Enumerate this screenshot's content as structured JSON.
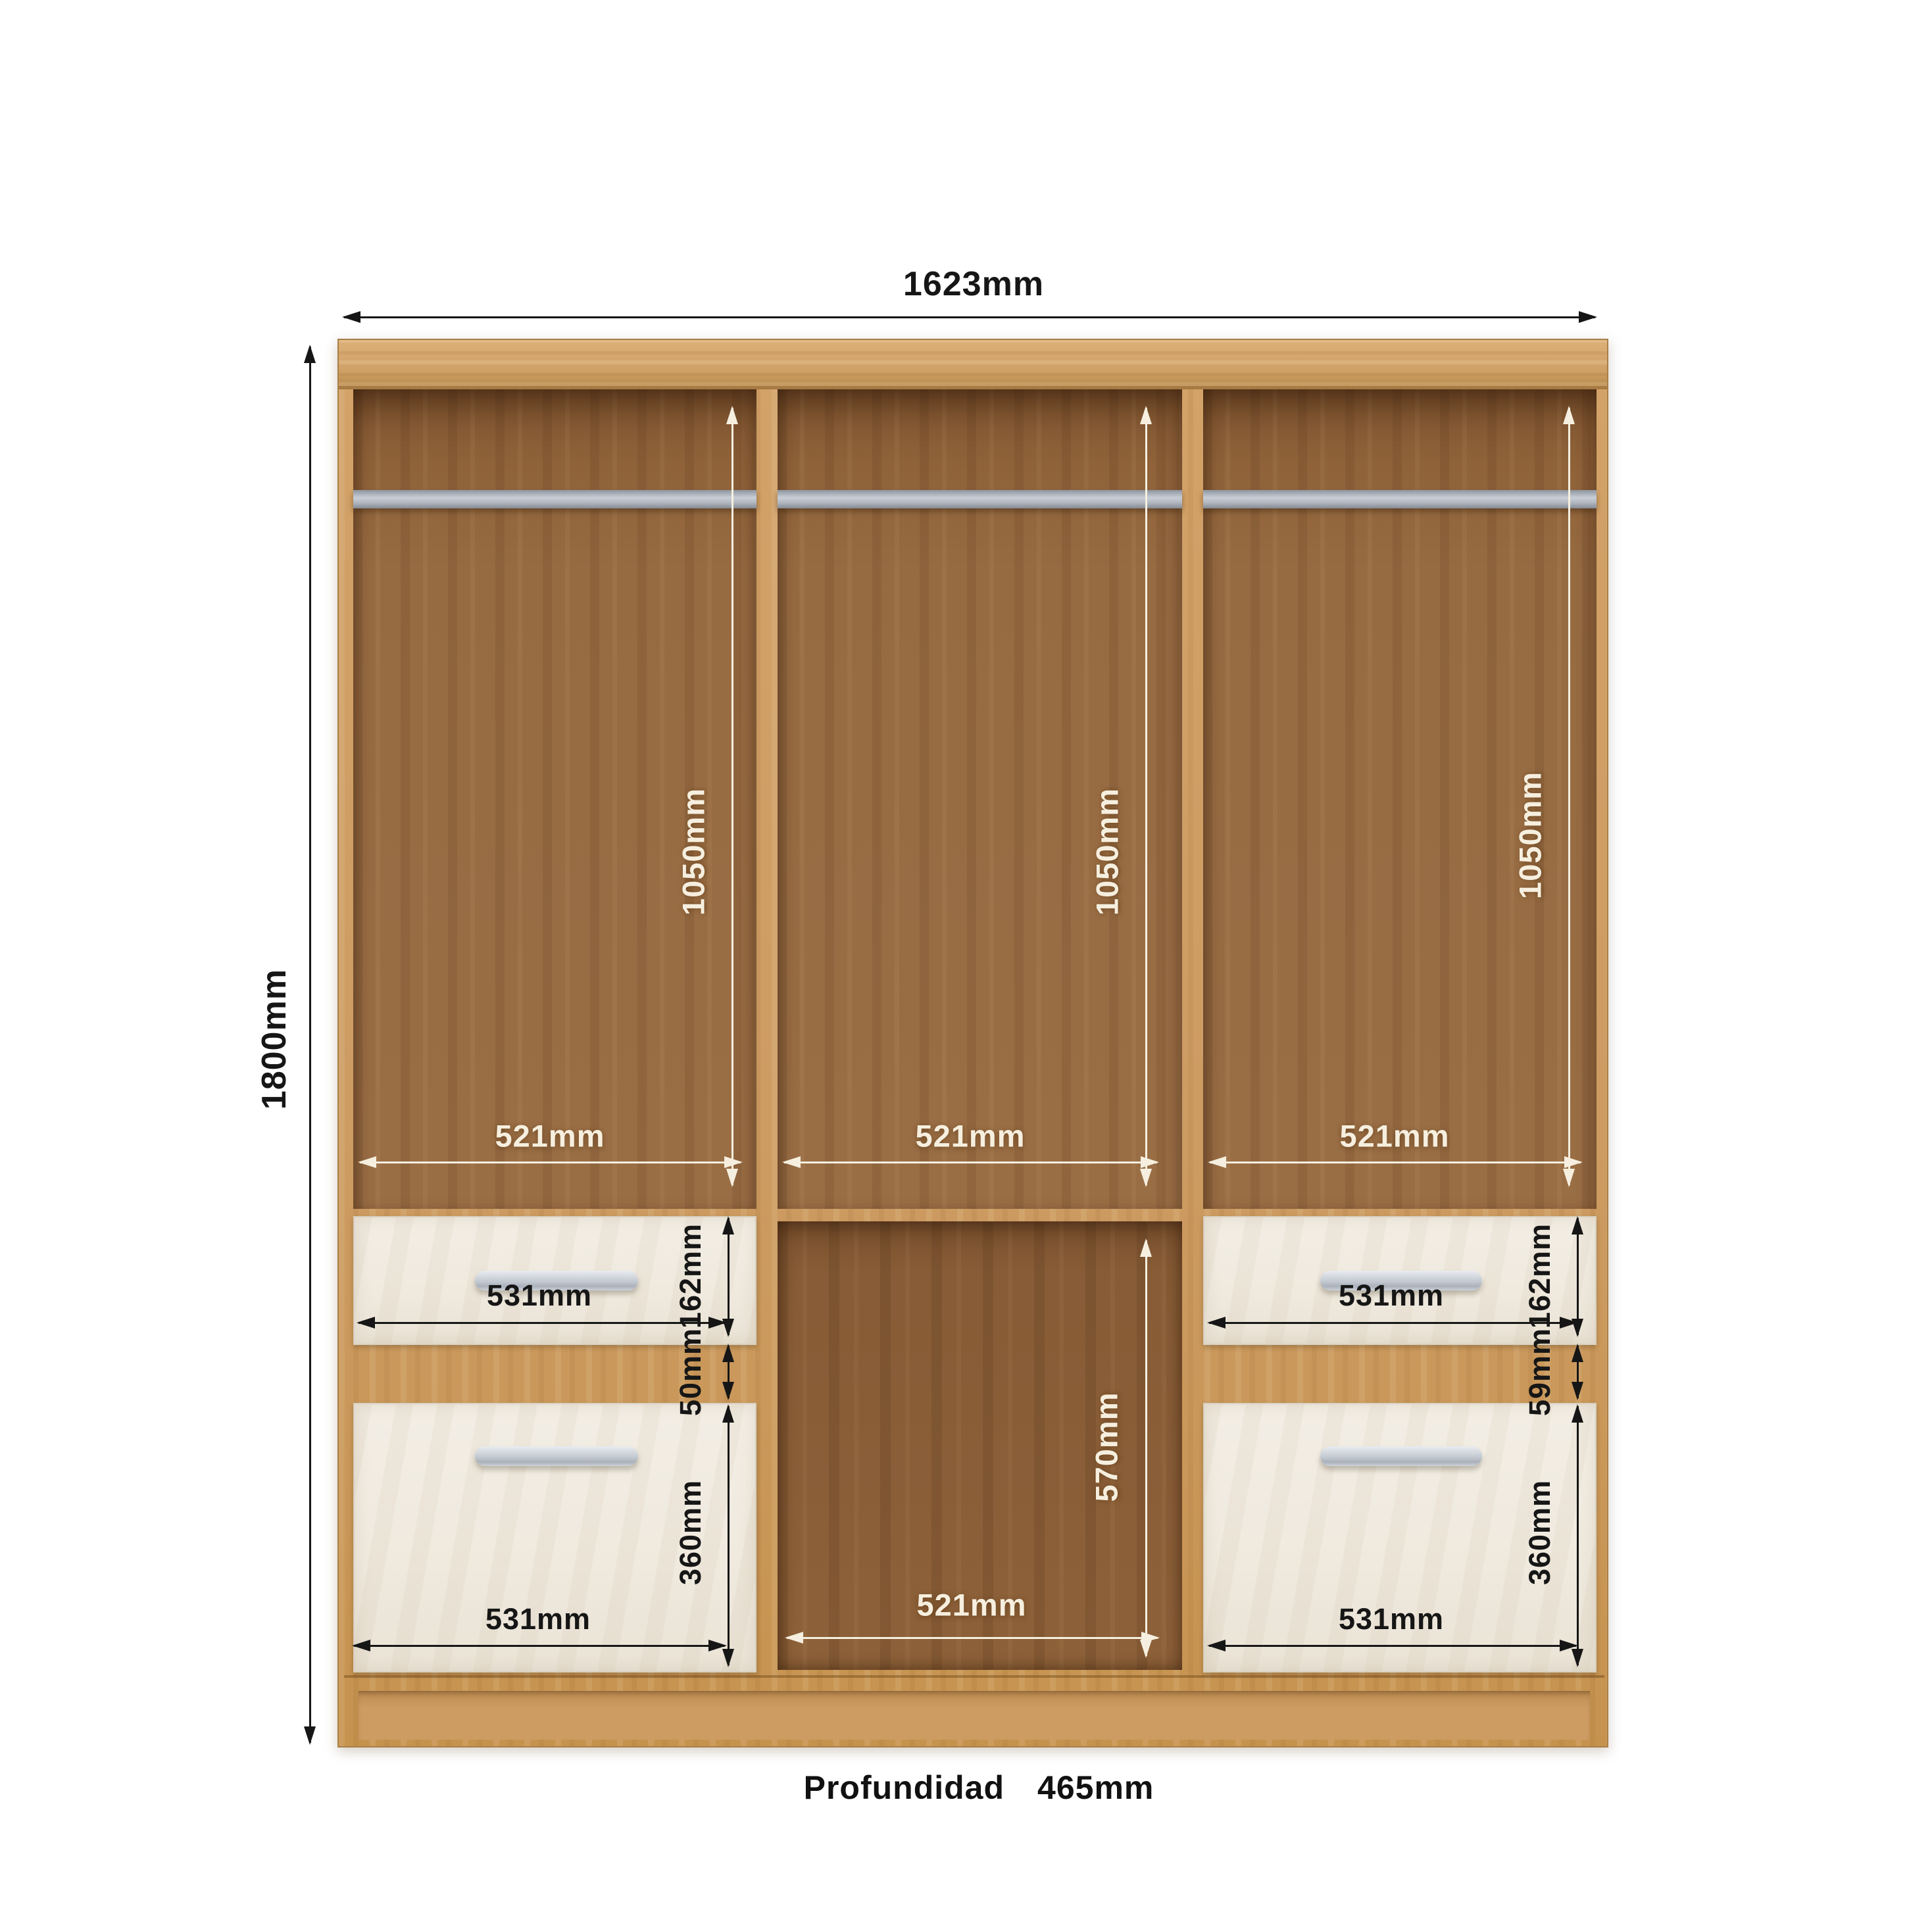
{
  "diagram": {
    "subject": "wardrobe-internal-dimensions-front-view"
  },
  "dims": {
    "overall_width": "1623mm",
    "overall_height": "1800mm",
    "hang_height_left": "1050mm",
    "hang_height_center": "1050mm",
    "hang_height_right": "1050mm",
    "hang_width_left": "521mm",
    "hang_width_center": "521mm",
    "hang_width_right": "521mm",
    "top_drawer_width_left": "531mm",
    "top_drawer_width_right": "531mm",
    "bottom_drawer_width_left": "531mm",
    "bottom_drawer_width_right": "531mm",
    "top_drawer_height_left": "162mm",
    "top_drawer_height_right": "162mm",
    "drawer_gap_left": "50mm",
    "drawer_gap_right": "59mm",
    "bottom_drawer_height_left": "360mm",
    "bottom_drawer_height_right": "360mm",
    "open_shelf_height": "570mm",
    "open_shelf_width": "521mm"
  },
  "footer": {
    "depth_label": "Profundidad",
    "depth_value": "465mm"
  },
  "colors": {
    "background": "#ffffff",
    "carcass_oak": "#cd9c63",
    "interior_wood": "#976b42",
    "drawer_front": "#efe9de",
    "hanging_rail": "#b6bbc3",
    "handle": "#c9cfd7",
    "dim_dark": "#161616",
    "dim_light": "#f6efdf"
  }
}
